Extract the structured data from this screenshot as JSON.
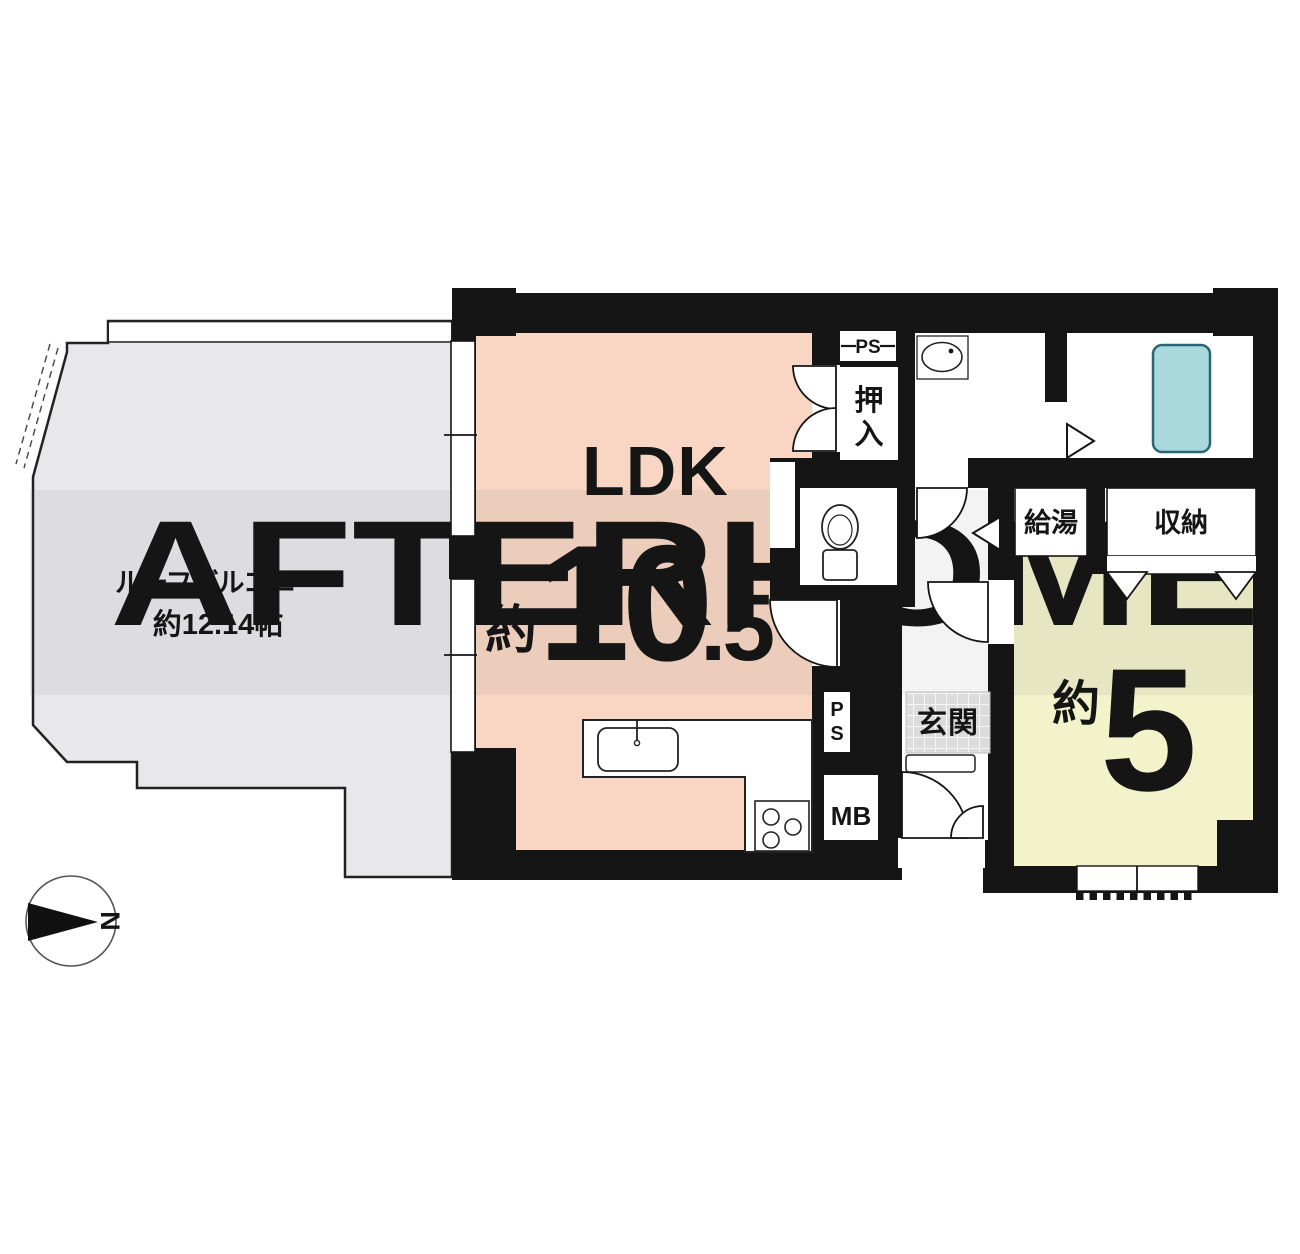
{
  "watermark": {
    "text": "AFTERHOME"
  },
  "compass": {
    "north": "N"
  },
  "balcony": {
    "line1": "ルーフバルコニー",
    "line2": "約12.14帖"
  },
  "ldk": {
    "label": "LDK",
    "approx": "約",
    "size_int": "10",
    "size_frac": ".5"
  },
  "room5": {
    "approx": "約",
    "size": "5"
  },
  "labels": {
    "oshiire_1": "押",
    "oshiire_2": "入",
    "kyuto": "給湯",
    "shuno": "収納",
    "genkan": "玄関",
    "ps_top": "PS",
    "ps_p": "P",
    "ps_s": "S",
    "mb": "MB"
  },
  "colors": {
    "wall": "#151515",
    "ldk": "#f8d6c3",
    "room5": "#f2f2cb",
    "balcony": "#e8e8ea",
    "bathtub": "#a9d8dd",
    "bathtub_border": "#2a6573",
    "genkan_tile": "#dcdcdc"
  }
}
